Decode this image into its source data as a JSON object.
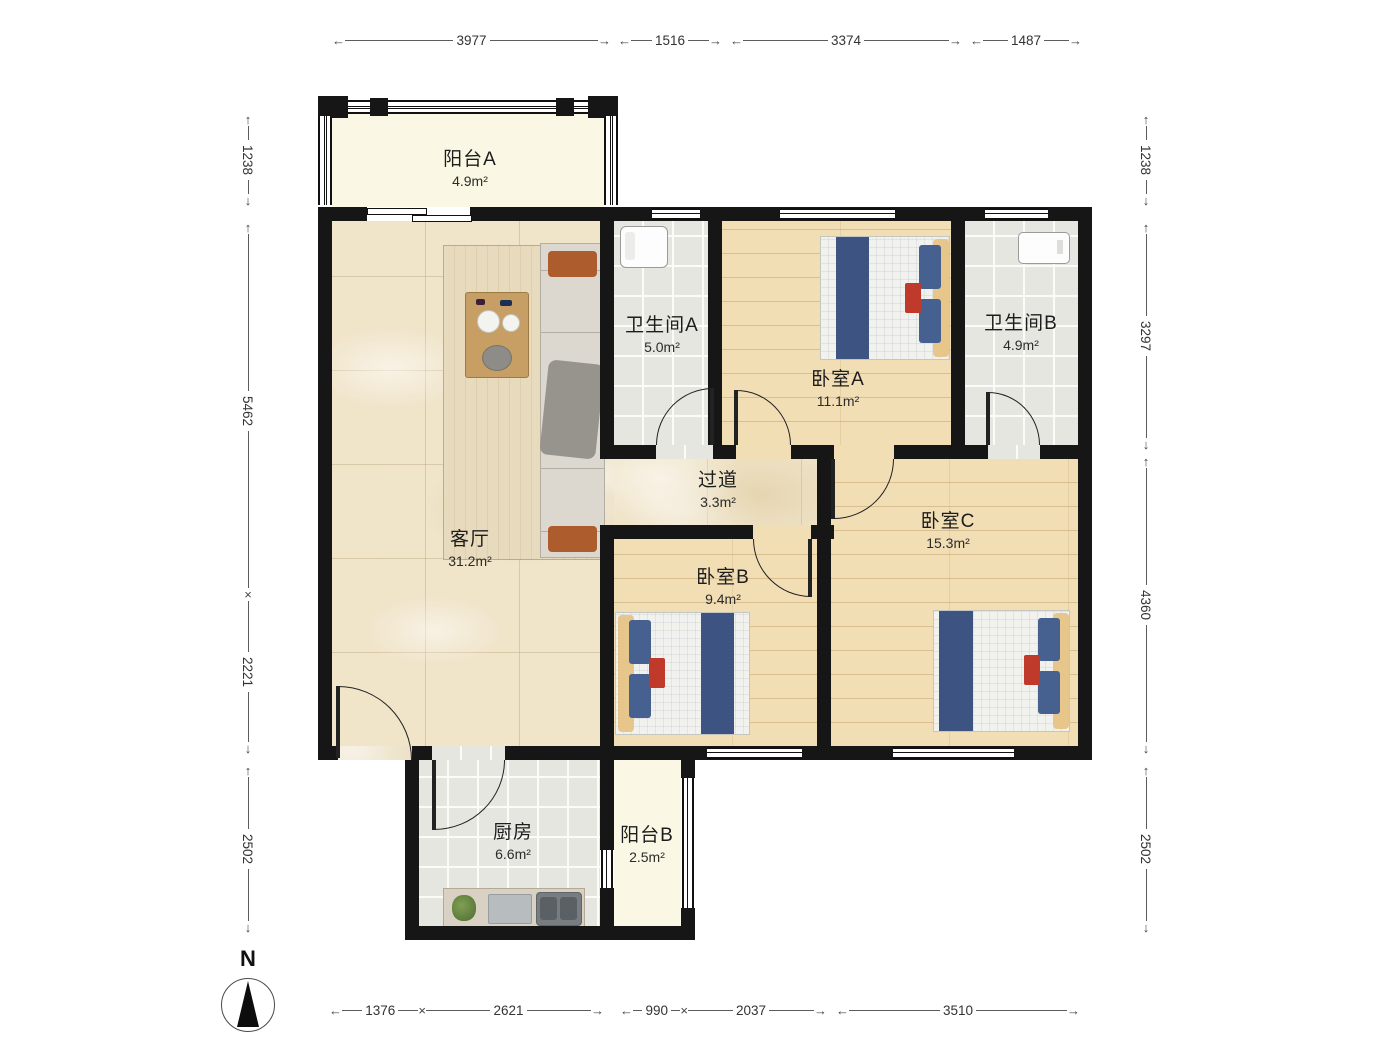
{
  "plan": {
    "rooms": [
      {
        "id": "balcony-a",
        "name": "阳台A",
        "area": "4.9m²"
      },
      {
        "id": "bathroom-a",
        "name": "卫生间A",
        "area": "5.0m²"
      },
      {
        "id": "bedroom-a",
        "name": "卧室A",
        "area": "11.1m²"
      },
      {
        "id": "bathroom-b",
        "name": "卫生间B",
        "area": "4.9m²"
      },
      {
        "id": "living-room",
        "name": "客厅",
        "area": "31.2m²"
      },
      {
        "id": "hallway",
        "name": "过道",
        "area": "3.3m²"
      },
      {
        "id": "bedroom-b",
        "name": "卧室B",
        "area": "9.4m²"
      },
      {
        "id": "bedroom-c",
        "name": "卧室C",
        "area": "15.3m²"
      },
      {
        "id": "kitchen",
        "name": "厨房",
        "area": "6.6m²"
      },
      {
        "id": "balcony-b",
        "name": "阳台B",
        "area": "2.5m²"
      }
    ],
    "dimensions": {
      "top": [
        "3977",
        "1516",
        "3374",
        "1487"
      ],
      "left": [
        "1238",
        "5462",
        "2221",
        "2502"
      ],
      "right": [
        "1238",
        "3297",
        "4360",
        "2502"
      ],
      "bottom": [
        "1376",
        "2621",
        "990",
        "2037",
        "3510"
      ]
    },
    "compass": {
      "label": "N"
    },
    "colors": {
      "wall": "#161616",
      "wood_floor": "#f2deb5",
      "marble_floor": "#f0e4c9",
      "tile_floor": "#e6e6e1",
      "balcony_floor": "#faf8e4",
      "bed_blue": "#3d5483",
      "accent_red": "#bf3a2b",
      "sofa_orange": "#ad5c2e"
    }
  }
}
